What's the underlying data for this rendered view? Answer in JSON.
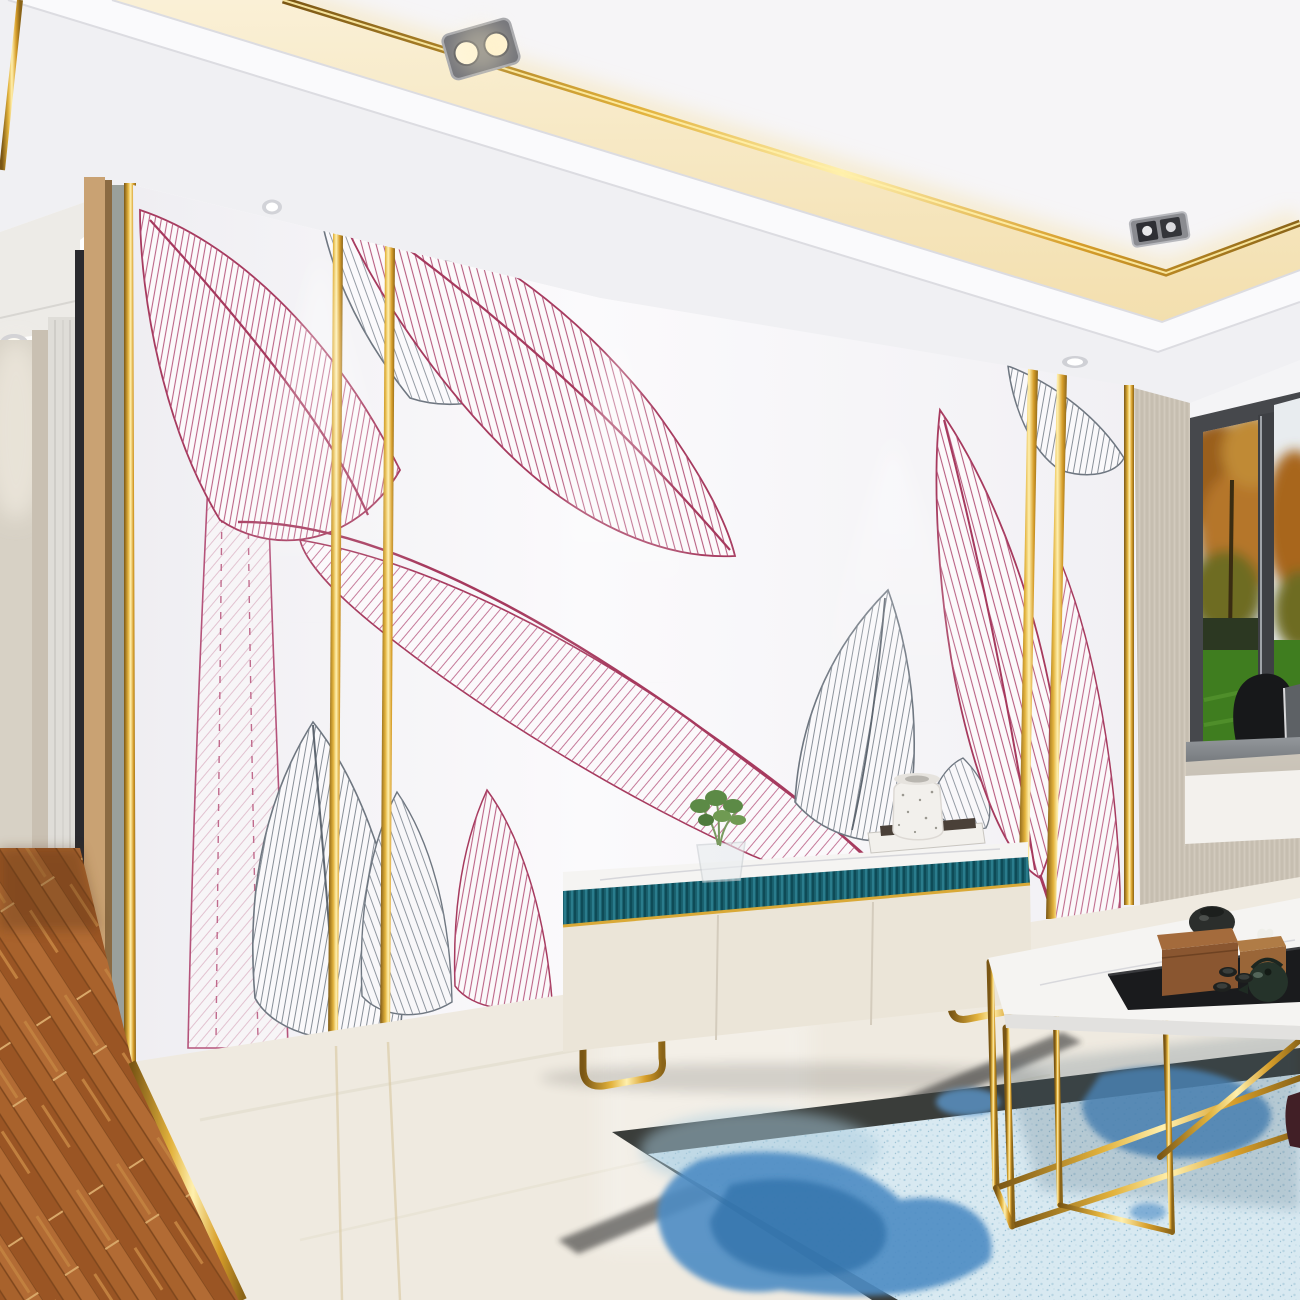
{
  "scene": {
    "type": "interior-3d-render",
    "description": "Modern living room: white feature wall with pink and gray banana-leaf line-art mural and vertical gold inlay strips, recessed ceiling with gold trim and warm LED cove, spotlights and downlights, cream TV console with teal fluted band and gold legs, marble floor with gold seams, wood-plank hallway floor, blue watercolor rug, gold-frame marble coffee table with tea set, bay window with autumn trees and lawn, gray window-seat cushion with pillows",
    "objects": [
      "ceiling",
      "gold-ceiling-trim",
      "led-cove",
      "spotlight-fixtures",
      "downlights",
      "hallway",
      "wall-panels",
      "mural-wall",
      "gold-wall-strips",
      "banana-leaves",
      "tv-console",
      "plant-vase",
      "books",
      "speckled-jar",
      "bay-window",
      "window-seat",
      "beige-column",
      "marble-floor",
      "wood-floor",
      "watercolor-rug",
      "coffee-table",
      "tea-tray",
      "teapot",
      "tea-cups",
      "wooden-box",
      "tissue-box"
    ]
  },
  "palette": {
    "ceilingWhite": "#F0F0F3",
    "panelWhite": "#F6F5F7",
    "crownWhite": "#FAFAFC",
    "creamGlow": "#F7E8C6",
    "gold": "#D9A937",
    "goldDark": "#8A5E14",
    "goldLight": "#FFE9A0",
    "wallWhite": "#F5F4F7",
    "leafPink": "#B04A6E",
    "leafGray": "#6E7680",
    "hallBeige": "#D7D1C5",
    "hallBeigeDeep": "#C9C0B2",
    "curtainGray": "#DFDDD8",
    "woodPanel": "#C9A273",
    "grayPanel": "#9AA09B",
    "darkSlit": "#2A2A2E",
    "columnBeige": "#CBC3B6",
    "windowFrame": "#46484C",
    "sky": "#C7CCD2",
    "foliageOrange": "#B06F22",
    "foliageOlive": "#6E6C20",
    "hedge": "#2C3822",
    "lawn": "#3F7D1F",
    "cushionGray": "#7E8286",
    "pillowBlack": "#17181A",
    "pillowGray": "#5D6165",
    "sillBeige": "#D9D1C3",
    "lowerPanelWhite": "#F3F1ED",
    "cabinetCream": "#EBE5D8",
    "cabinetTeal": "#19616F",
    "marbleTop": "#F5F4F2",
    "floorMarble": "#EFEAE0",
    "rugBorder": "#3A3D3A",
    "rugField": "#D8E9F1",
    "rugBlue": "#4E8CC4",
    "rugBlueDark": "#2F6FA8",
    "trayBlack": "#1A1B1D",
    "woodBox": "#8A5630",
    "woodBoxTop": "#A46B3C",
    "tissueBox": "#9A6638",
    "teapotGreen": "#25332A",
    "cupDark": "#1E211F",
    "jarDark": "#2B2E2C",
    "plantGreen": "#5C8A46",
    "bookCover": "#4A4038",
    "shadow": "#2F312F",
    "darkVase": "#411F26"
  }
}
